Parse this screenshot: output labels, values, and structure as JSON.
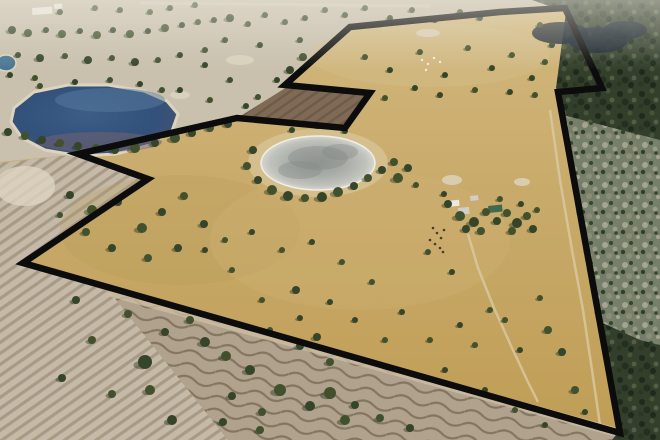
{
  "scene": {
    "type": "aerial-photograph",
    "description": "Aerial drone photo of dry Australian farmland with a thick black property-boundary outline; blue lake top-left, grey dried clay pan centre, dark bushland on the right, ploughed furrowed paddocks lower-left and bottom, farm sheds centre-right",
    "width": 660,
    "height": 440
  },
  "palette": {
    "boundary": "#0c0c0c",
    "grass_top": "#d2b87e",
    "grass_mid": "#c8aa6a",
    "grass_bottom": "#bf9d55",
    "paddock_pale": "#c9c0ad",
    "haze": "#ece8dd",
    "lake_deep": "#32527c",
    "lake_core": "#3c5d85",
    "lake_edge": "#6a5e72",
    "lake_light": "#5a7ba0",
    "lake_shallow": "#75636f",
    "shore": "#dcd4bd",
    "dam": "#4a7693",
    "forest": "#333f2b",
    "forest_dark": "#16222e",
    "scrub": "#7d8670",
    "furrow_base": "#c5baa8",
    "furrow_line": "#a79b86",
    "wavy_base": "#b1a28e",
    "wavy_line": "#837560",
    "headland": "#cfc0a3",
    "tilled": "#7f6b55",
    "tilled_line": "#6f5c48",
    "pan_halo": "#d7c394",
    "tree": "#41512d",
    "tree_alt": "#35452a",
    "tree_shadow": "#202a16",
    "track": "#d9c9a1",
    "sand": "#ddd5c0",
    "building_white": "#eae8e0",
    "building_grey": "#d0cec6",
    "building_green": "#3e6b4e",
    "livestock_dark": "#473c2d",
    "sheep_white": "#f0ede2"
  },
  "boundary": {
    "stroke_width": 6.5,
    "points": [
      [
        500,
        12
      ],
      [
        565,
        8
      ],
      [
        602,
        88
      ],
      [
        558,
        92
      ],
      [
        620,
        433
      ],
      [
        23,
        263
      ],
      [
        148,
        179
      ],
      [
        78,
        154
      ],
      [
        237,
        118
      ],
      [
        345,
        128
      ],
      [
        370,
        93
      ],
      [
        285,
        85
      ],
      [
        350,
        27
      ]
    ]
  },
  "outside_pale": {
    "points": [
      [
        0,
        0
      ],
      [
        660,
        0
      ],
      [
        660,
        14
      ],
      [
        565,
        8
      ],
      [
        500,
        12
      ],
      [
        350,
        27
      ],
      [
        285,
        85
      ],
      [
        370,
        93
      ],
      [
        345,
        128
      ],
      [
        237,
        118
      ],
      [
        78,
        154
      ],
      [
        0,
        162
      ]
    ]
  },
  "forest": {
    "points": [
      [
        532,
        0
      ],
      [
        660,
        0
      ],
      [
        660,
        440
      ],
      [
        612,
        440
      ],
      [
        619,
        431
      ],
      [
        560,
        95
      ],
      [
        556,
        88
      ],
      [
        566,
        12
      ]
    ]
  },
  "forest_dark_patches": [
    [
      560,
      33,
      28,
      11
    ],
    [
      598,
      40,
      30,
      13
    ],
    [
      625,
      30,
      22,
      9
    ]
  ],
  "scrub_overlay": {
    "points": [
      [
        563,
        115
      ],
      [
        660,
        140
      ],
      [
        660,
        345
      ],
      [
        640,
        340
      ],
      [
        596,
        320
      ],
      [
        576,
        210
      ]
    ]
  },
  "left_field": {
    "points": [
      [
        0,
        163
      ],
      [
        70,
        155
      ],
      [
        148,
        179
      ],
      [
        23,
        263
      ],
      [
        110,
        292
      ],
      [
        228,
        440
      ],
      [
        0,
        440
      ]
    ]
  },
  "bottom_field": {
    "points": [
      [
        110,
        292
      ],
      [
        619,
        433
      ],
      [
        612,
        440
      ],
      [
        228,
        440
      ]
    ]
  },
  "headland_line": [
    [
      110,
      292
    ],
    [
      619,
      433
    ]
  ],
  "tilled_field": {
    "points": [
      [
        239,
        117
      ],
      [
        343,
        127
      ],
      [
        367,
        94
      ],
      [
        287,
        87
      ]
    ]
  },
  "lake": {
    "points": [
      [
        14,
        108
      ],
      [
        34,
        92
      ],
      [
        68,
        85
      ],
      [
        108,
        85
      ],
      [
        144,
        91
      ],
      [
        167,
        101
      ],
      [
        178,
        114
      ],
      [
        172,
        131
      ],
      [
        150,
        145
      ],
      [
        116,
        154
      ],
      [
        80,
        156
      ],
      [
        45,
        150
      ],
      [
        22,
        138
      ],
      [
        11,
        122
      ]
    ],
    "highlight": [
      110,
      100,
      55,
      12
    ],
    "shallow_band": [
      100,
      142,
      62,
      10
    ]
  },
  "dam": [
    6,
    63,
    10,
    8
  ],
  "clay_pan": {
    "halo": [
      318,
      163,
      70,
      34
    ],
    "pan": [
      318,
      163,
      57,
      27
    ],
    "mottles": [
      [
        318,
        158,
        30,
        12
      ],
      [
        300,
        170,
        22,
        9
      ],
      [
        340,
        152,
        18,
        8
      ]
    ]
  },
  "sand_patches": [
    [
      428,
      33,
      12,
      4
    ],
    [
      452,
      180,
      10,
      5
    ],
    [
      522,
      182,
      8,
      4
    ],
    [
      240,
      60,
      14,
      5
    ],
    [
      180,
      95,
      10,
      4
    ],
    [
      25,
      186,
      30,
      20
    ]
  ],
  "road_top": [
    [
      140,
      3
    ],
    [
      430,
      6
    ]
  ],
  "sheds_far": [
    [
      32,
      8,
      20,
      7
    ],
    [
      54,
      4,
      8,
      5
    ]
  ],
  "buildings": [
    {
      "x": 447,
      "y": 201,
      "w": 12,
      "h": 6,
      "fill": "building_white"
    },
    {
      "x": 458,
      "y": 208,
      "w": 11,
      "h": 7,
      "fill": "building_grey"
    },
    {
      "x": 488,
      "y": 206,
      "w": 14,
      "h": 7,
      "fill": "building_green"
    },
    {
      "x": 470,
      "y": 196,
      "w": 8,
      "h": 5,
      "fill": "building_grey"
    }
  ],
  "tracks": [
    [
      [
        550,
        110
      ],
      [
        560,
        180
      ],
      [
        572,
        250
      ],
      [
        583,
        310
      ],
      [
        592,
        370
      ],
      [
        600,
        425
      ]
    ],
    [
      [
        468,
        234
      ],
      [
        478,
        268
      ],
      [
        494,
        308
      ],
      [
        512,
        348
      ],
      [
        528,
        382
      ],
      [
        538,
        402
      ]
    ]
  ],
  "livestock_dark": [
    [
      433,
      228
    ],
    [
      437,
      233
    ],
    [
      441,
      238
    ],
    [
      435,
      244
    ],
    [
      440,
      248
    ],
    [
      444,
      230
    ],
    [
      430,
      240
    ],
    [
      443,
      252
    ]
  ],
  "sheep_white": [
    [
      422,
      60
    ],
    [
      428,
      64
    ],
    [
      434,
      58
    ],
    [
      440,
      62
    ],
    [
      426,
      70
    ]
  ],
  "variation_blobs": [
    [
      430,
      55,
      120,
      32,
      "#d3bd8a",
      0.45
    ],
    [
      180,
      230,
      120,
      55,
      "#b99b58",
      0.25
    ],
    [
      360,
      240,
      150,
      70,
      "#d0b277",
      0.3
    ]
  ],
  "trees": [
    [
      12,
      30,
      4
    ],
    [
      28,
      33,
      4
    ],
    [
      46,
      30,
      3
    ],
    [
      62,
      34,
      4
    ],
    [
      80,
      31,
      3
    ],
    [
      97,
      35,
      4
    ],
    [
      113,
      30,
      3
    ],
    [
      130,
      34,
      4
    ],
    [
      148,
      31,
      3
    ],
    [
      165,
      28,
      4
    ],
    [
      182,
      25,
      3
    ],
    [
      198,
      22,
      3
    ],
    [
      214,
      20,
      3
    ],
    [
      18,
      55,
      3
    ],
    [
      40,
      58,
      4
    ],
    [
      65,
      56,
      3
    ],
    [
      88,
      60,
      4
    ],
    [
      112,
      58,
      3
    ],
    [
      135,
      62,
      4
    ],
    [
      158,
      60,
      3
    ],
    [
      180,
      55,
      3
    ],
    [
      205,
      50,
      3
    ],
    [
      10,
      75,
      3
    ],
    [
      35,
      78,
      3
    ],
    [
      60,
      12,
      3
    ],
    [
      95,
      8,
      3
    ],
    [
      120,
      10,
      3
    ],
    [
      150,
      12,
      3
    ],
    [
      170,
      8,
      3
    ],
    [
      195,
      5,
      3
    ],
    [
      230,
      18,
      4
    ],
    [
      248,
      24,
      3
    ],
    [
      265,
      15,
      3
    ],
    [
      285,
      22,
      3
    ],
    [
      305,
      18,
      3
    ],
    [
      325,
      10,
      3
    ],
    [
      345,
      15,
      3
    ],
    [
      365,
      8,
      3
    ],
    [
      390,
      18,
      3
    ],
    [
      412,
      10,
      3
    ],
    [
      435,
      20,
      3
    ],
    [
      460,
      12,
      3
    ],
    [
      480,
      18,
      3
    ],
    [
      300,
      40,
      3
    ],
    [
      260,
      45,
      3
    ],
    [
      225,
      40,
      3
    ],
    [
      205,
      65,
      3
    ],
    [
      230,
      80,
      3
    ],
    [
      180,
      90,
      3
    ],
    [
      210,
      100,
      3
    ],
    [
      8,
      132,
      4
    ],
    [
      25,
      136,
      4
    ],
    [
      42,
      140,
      4
    ],
    [
      60,
      143,
      4
    ],
    [
      78,
      146,
      4
    ],
    [
      96,
      148,
      4
    ],
    [
      115,
      150,
      4
    ],
    [
      135,
      148,
      5
    ],
    [
      155,
      143,
      4
    ],
    [
      175,
      138,
      5
    ],
    [
      192,
      133,
      4
    ],
    [
      210,
      128,
      4
    ],
    [
      228,
      124,
      4
    ],
    [
      40,
      86,
      3
    ],
    [
      75,
      82,
      3
    ],
    [
      110,
      80,
      3
    ],
    [
      140,
      84,
      3
    ],
    [
      162,
      90,
      3
    ],
    [
      290,
      70,
      4
    ],
    [
      303,
      57,
      4
    ],
    [
      277,
      80,
      3
    ],
    [
      258,
      97,
      3
    ],
    [
      246,
      106,
      3
    ],
    [
      365,
      57,
      3
    ],
    [
      390,
      70,
      3
    ],
    [
      420,
      52,
      3
    ],
    [
      445,
      75,
      3
    ],
    [
      468,
      48,
      3
    ],
    [
      492,
      68,
      3
    ],
    [
      512,
      55,
      3
    ],
    [
      532,
      78,
      3
    ],
    [
      545,
      62,
      3
    ],
    [
      415,
      88,
      3
    ],
    [
      385,
      98,
      3
    ],
    [
      440,
      95,
      3
    ],
    [
      475,
      90,
      3
    ],
    [
      510,
      92,
      3
    ],
    [
      535,
      95,
      3
    ],
    [
      552,
      45,
      3
    ],
    [
      540,
      25,
      3
    ],
    [
      253,
      150,
      4
    ],
    [
      247,
      166,
      4
    ],
    [
      258,
      180,
      4
    ],
    [
      272,
      190,
      5
    ],
    [
      288,
      196,
      5
    ],
    [
      305,
      198,
      4
    ],
    [
      322,
      197,
      5
    ],
    [
      338,
      192,
      5
    ],
    [
      354,
      186,
      4
    ],
    [
      368,
      178,
      4
    ],
    [
      382,
      170,
      4
    ],
    [
      394,
      162,
      4
    ],
    [
      292,
      130,
      3
    ],
    [
      318,
      126,
      3
    ],
    [
      345,
      131,
      3
    ],
    [
      398,
      178,
      5
    ],
    [
      408,
      168,
      4
    ],
    [
      416,
      185,
      3
    ],
    [
      70,
      195,
      4
    ],
    [
      92,
      210,
      5
    ],
    [
      118,
      202,
      4
    ],
    [
      142,
      228,
      5
    ],
    [
      112,
      248,
      4
    ],
    [
      86,
      232,
      4
    ],
    [
      162,
      212,
      4
    ],
    [
      184,
      196,
      4
    ],
    [
      204,
      224,
      4
    ],
    [
      148,
      258,
      4
    ],
    [
      178,
      248,
      4
    ],
    [
      60,
      215,
      3
    ],
    [
      205,
      250,
      3
    ],
    [
      225,
      240,
      3
    ],
    [
      252,
      232,
      3
    ],
    [
      282,
      250,
      3
    ],
    [
      312,
      242,
      3
    ],
    [
      342,
      262,
      3
    ],
    [
      296,
      290,
      4
    ],
    [
      262,
      300,
      3
    ],
    [
      330,
      302,
      3
    ],
    [
      372,
      282,
      3
    ],
    [
      402,
      312,
      3
    ],
    [
      428,
      252,
      3
    ],
    [
      452,
      272,
      3
    ],
    [
      232,
      270,
      3
    ],
    [
      355,
      320,
      3
    ],
    [
      385,
      340,
      3
    ],
    [
      300,
      318,
      3
    ],
    [
      270,
      330,
      3
    ],
    [
      448,
      204,
      4
    ],
    [
      460,
      216,
      5
    ],
    [
      474,
      222,
      5
    ],
    [
      486,
      212,
      4
    ],
    [
      497,
      221,
      4
    ],
    [
      507,
      213,
      4
    ],
    [
      517,
      223,
      5
    ],
    [
      527,
      216,
      4
    ],
    [
      533,
      229,
      4
    ],
    [
      481,
      231,
      4
    ],
    [
      466,
      229,
      4
    ],
    [
      512,
      231,
      4
    ],
    [
      521,
      204,
      3
    ],
    [
      500,
      199,
      3
    ],
    [
      444,
      194,
      3
    ],
    [
      537,
      210,
      3
    ],
    [
      76,
      300,
      4
    ],
    [
      92,
      340,
      4
    ],
    [
      62,
      378,
      4
    ],
    [
      150,
      390,
      5
    ],
    [
      172,
      420,
      5
    ],
    [
      112,
      394,
      4
    ],
    [
      145,
      362,
      7
    ],
    [
      128,
      314,
      4
    ],
    [
      165,
      332,
      4
    ],
    [
      190,
      320,
      4
    ],
    [
      205,
      342,
      5
    ],
    [
      226,
      356,
      5
    ],
    [
      250,
      370,
      5
    ],
    [
      280,
      390,
      6
    ],
    [
      310,
      406,
      5
    ],
    [
      345,
      420,
      5
    ],
    [
      300,
      346,
      4
    ],
    [
      330,
      362,
      4
    ],
    [
      232,
      396,
      4
    ],
    [
      262,
      412,
      4
    ],
    [
      223,
      422,
      4
    ],
    [
      260,
      430,
      4
    ],
    [
      317,
      337,
      4
    ],
    [
      330,
      393,
      6
    ],
    [
      355,
      405,
      4
    ],
    [
      380,
      418,
      4
    ],
    [
      410,
      428,
      4
    ],
    [
      430,
      340,
      3
    ],
    [
      460,
      325,
      3
    ],
    [
      490,
      310,
      3
    ],
    [
      445,
      370,
      3
    ],
    [
      475,
      345,
      3
    ],
    [
      485,
      390,
      3
    ],
    [
      515,
      410,
      3
    ],
    [
      545,
      425,
      3
    ],
    [
      548,
      330,
      4
    ],
    [
      562,
      352,
      4
    ],
    [
      575,
      390,
      4
    ],
    [
      585,
      412,
      3
    ],
    [
      540,
      298,
      3
    ],
    [
      520,
      350,
      3
    ],
    [
      505,
      320,
      3
    ]
  ]
}
